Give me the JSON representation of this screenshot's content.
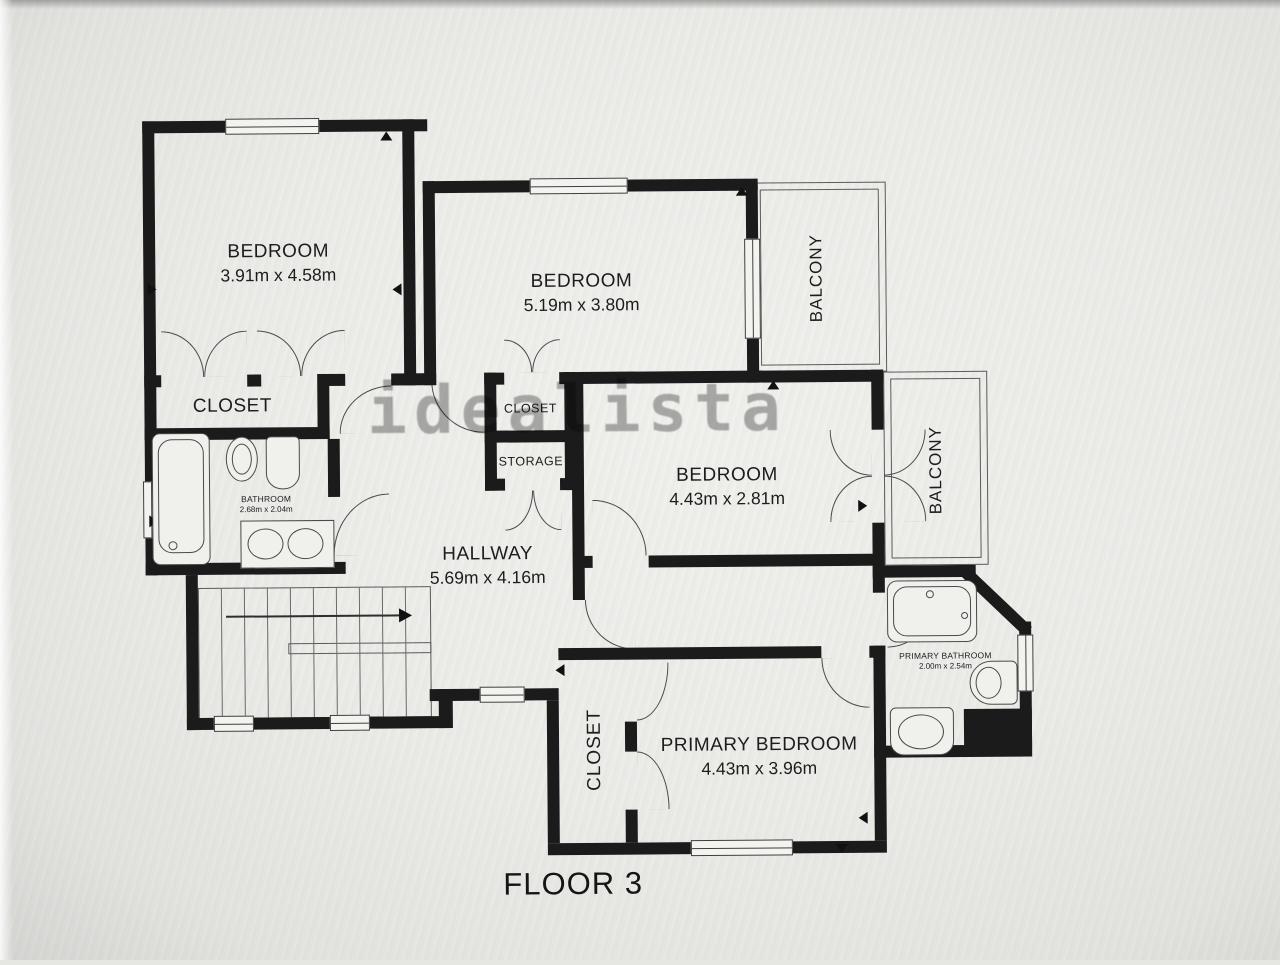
{
  "watermark": "idealista",
  "floor_label": "FLOOR 3",
  "rooms": {
    "bedroom_top_left": {
      "name": "BEDROOM",
      "dims": "3.91m x 4.58m"
    },
    "bedroom_top_middle": {
      "name": "BEDROOM",
      "dims": "5.19m x 3.80m"
    },
    "bedroom_middle_right": {
      "name": "BEDROOM",
      "dims": "4.43m x 2.81m"
    },
    "primary_bedroom": {
      "name": "PRIMARY BEDROOM",
      "dims": "4.43m x 3.96m"
    },
    "hallway": {
      "name": "HALLWAY",
      "dims": "5.69m x 4.16m"
    },
    "bathroom": {
      "name": "BATHROOM",
      "dims": "2.68m x 2.04m"
    },
    "primary_bathroom": {
      "name": "PRIMARY BATHROOM",
      "dims": "2.00m x 2.54m"
    },
    "closet_bedroom1": {
      "name": "CLOSET"
    },
    "closet_bedroom2": {
      "name": "CLOSET"
    },
    "storage": {
      "name": "STORAGE"
    },
    "closet_primary": {
      "name": "CLOSET"
    },
    "balcony_top": {
      "name": "BALCONY"
    },
    "balcony_right": {
      "name": "BALCONY"
    }
  },
  "colors": {
    "walls": "#1b1b1b",
    "thin_lines": "#4a4a4a",
    "floor": "#ebebe7",
    "watermark": "#696969"
  }
}
